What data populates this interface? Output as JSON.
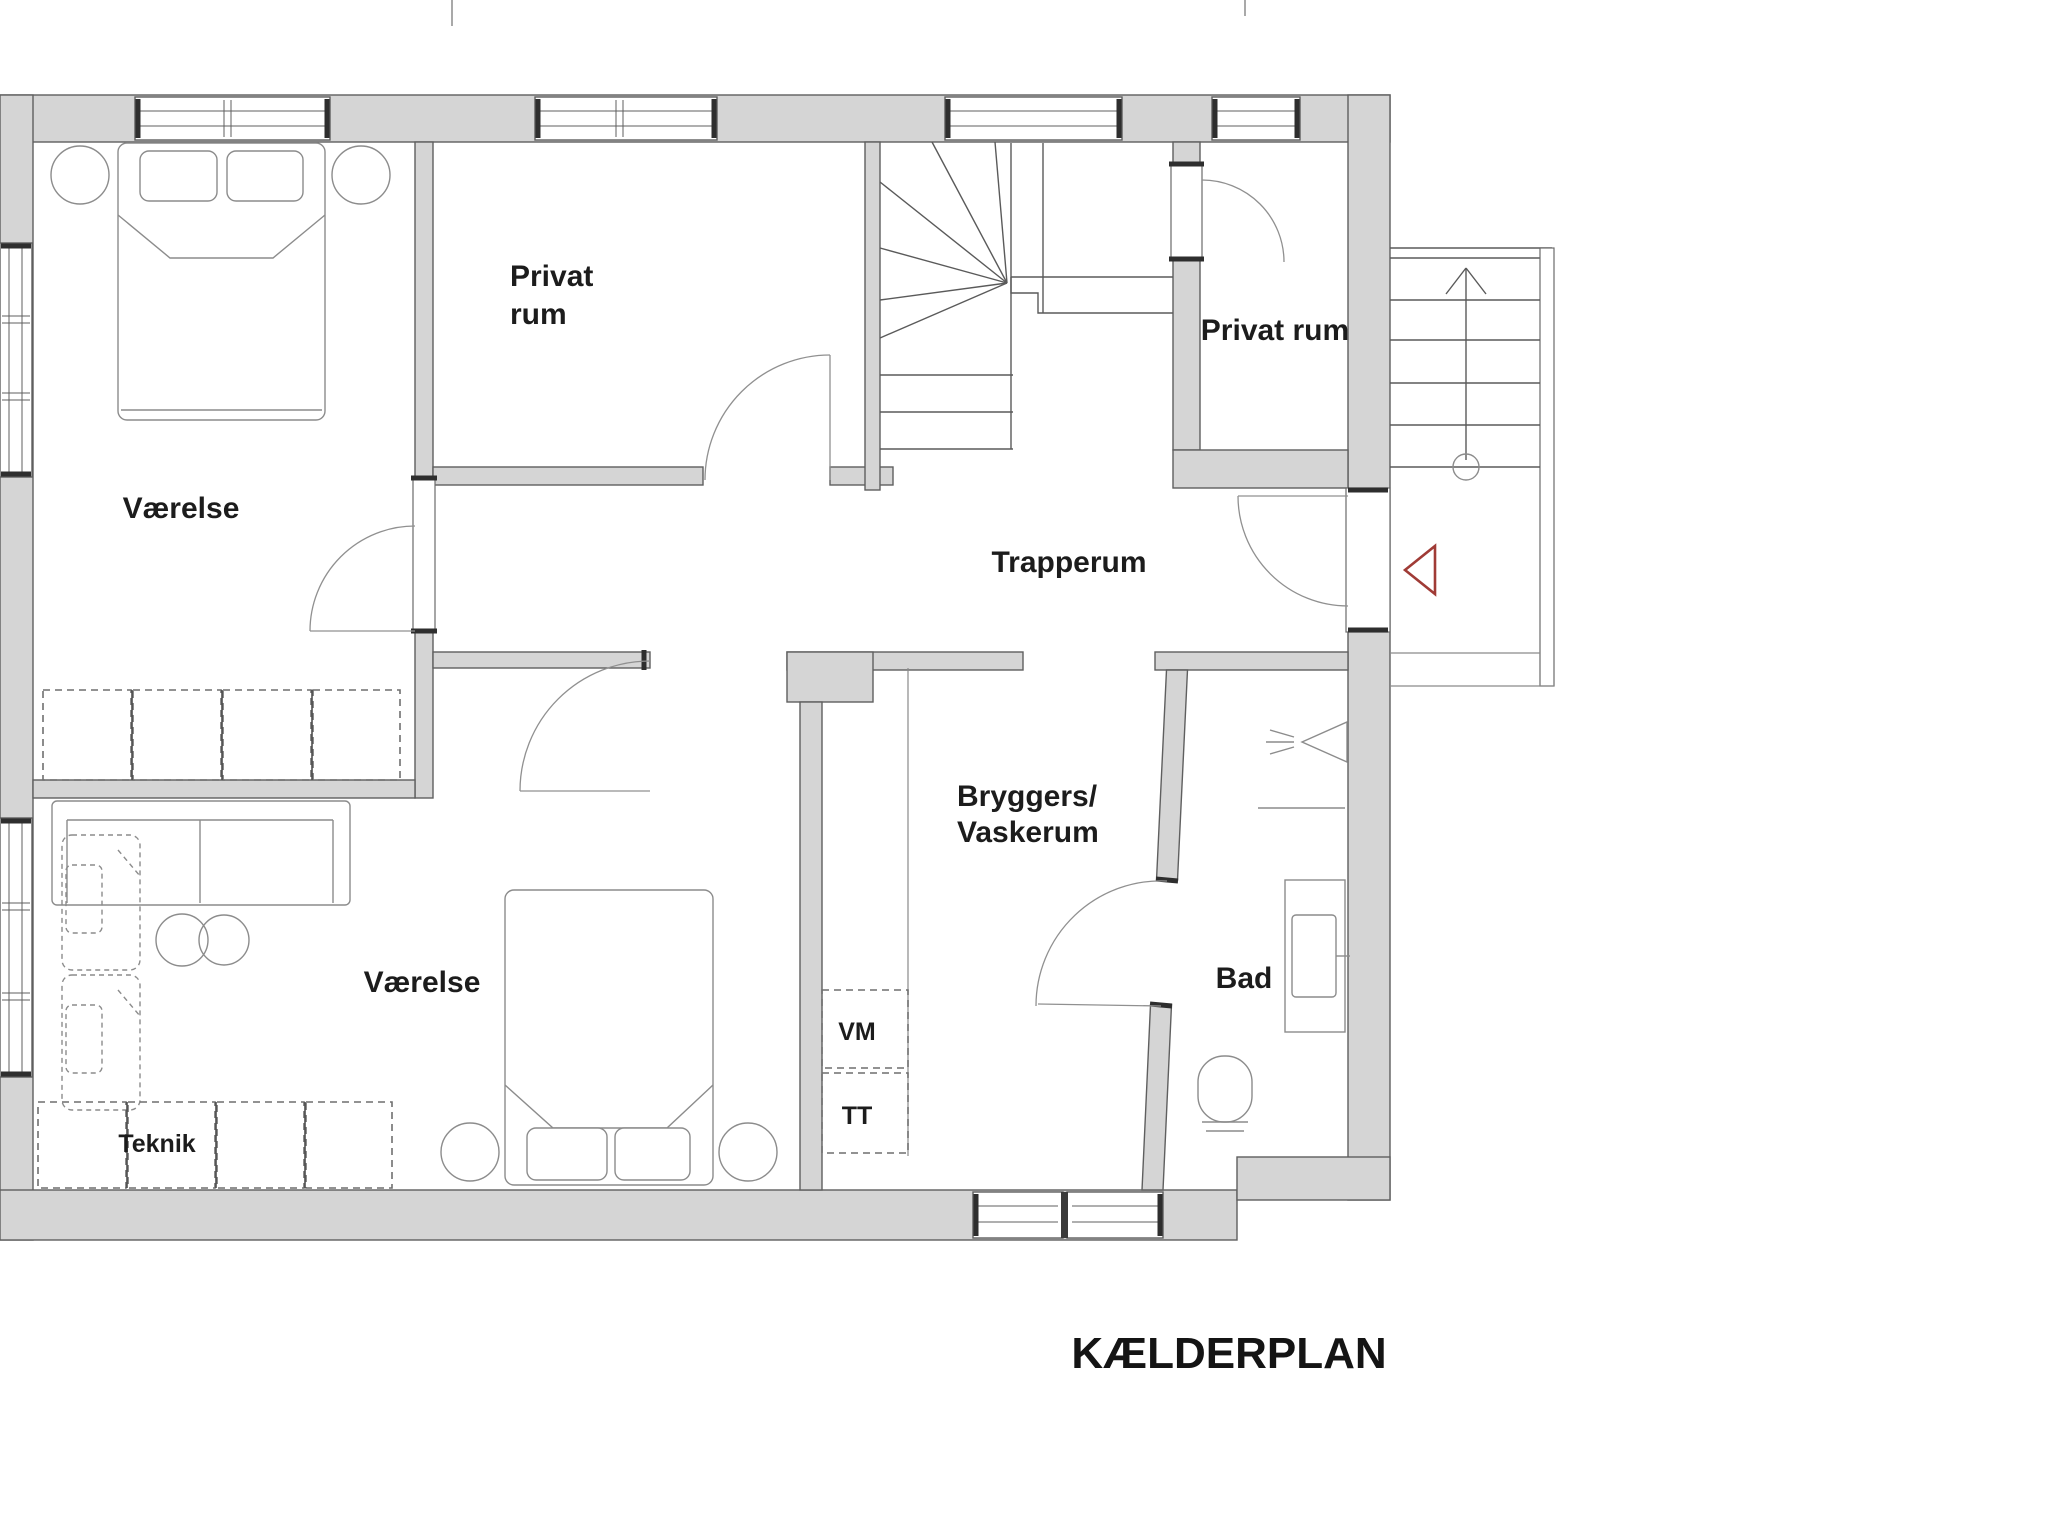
{
  "title": "KÆLDERPLAN",
  "rooms": {
    "bedroom_top": {
      "label": "Værelse"
    },
    "private_room_top": {
      "line1": "Privat",
      "line2": "rum"
    },
    "stair_room": {
      "label": "Trapperum"
    },
    "private_room_right": {
      "label": "Privat rum"
    },
    "utility_room": {
      "line1": "Bryggers/",
      "line2": "Vaskerum"
    },
    "bathroom": {
      "label": "Bad"
    },
    "bedroom_bottom": {
      "label": "Værelse"
    },
    "technical": {
      "label": "Teknik"
    },
    "washer": {
      "label": "VM"
    },
    "dryer": {
      "label": "TT"
    }
  },
  "symbols": {
    "entrance_marker": "red-triangle-pointing-left",
    "exterior_stairs_direction": "arrow-up",
    "shower": "shower-spray-icon"
  },
  "colors": {
    "wall_fill": "#d5d5d5",
    "wall_stroke": "#5f5f5f",
    "furniture_stroke": "#8c8c8c",
    "text": "#1c1c1c",
    "accent_red": "#a03b36"
  }
}
